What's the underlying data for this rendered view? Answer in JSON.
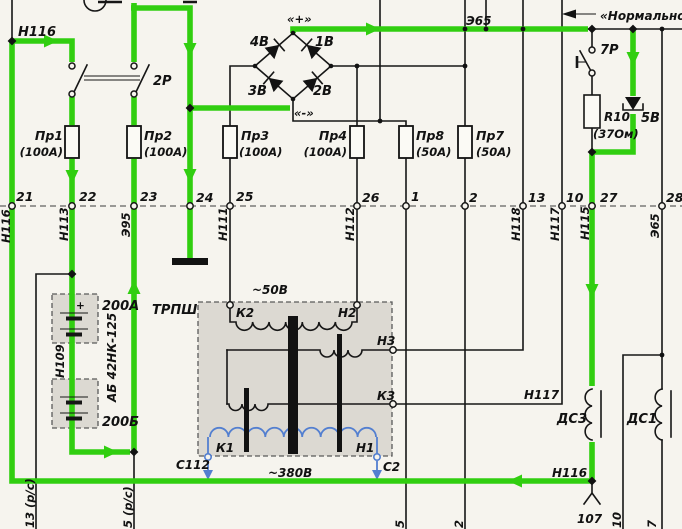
{
  "colors": {
    "wire_active": "#31ce10",
    "winding_blue": "#537fd0",
    "paper": "#f6f4ee",
    "panel_fill": "#dcd9d2"
  },
  "top_left": {
    "wire_label": "Н116"
  },
  "switches": {
    "s2p": "2Р",
    "s7p": "7Р"
  },
  "bridge": {
    "plus": "«+»",
    "minus": "«-»",
    "d1": "1В",
    "d2": "2В",
    "d3": "3В",
    "d4": "4В"
  },
  "top_right": {
    "bus": "Э65",
    "note": "«Нормально",
    "resistor": "R10",
    "resistor_value": "(37Ом)",
    "diode": "5В"
  },
  "fuses": [
    {
      "name": "Пр1",
      "rating": "(100А)"
    },
    {
      "name": "Пр2",
      "rating": "(100А)"
    },
    {
      "name": "Пр3",
      "rating": "(100А)"
    },
    {
      "name": "Пр4",
      "rating": "(100А)"
    },
    {
      "name": "Пр8",
      "rating": "(50А)"
    },
    {
      "name": "Пр7",
      "rating": "(50А)"
    }
  ],
  "terminals": [
    {
      "num": "21",
      "wire": "Н116"
    },
    {
      "num": "22",
      "wire": "Н113"
    },
    {
      "num": "23",
      "wire": "Э95"
    },
    {
      "num": "24",
      "wire": ""
    },
    {
      "num": "25",
      "wire": "Н111"
    },
    {
      "num": "26",
      "wire": "Н112"
    },
    {
      "num": "1",
      "wire": ""
    },
    {
      "num": "2",
      "wire": ""
    },
    {
      "num": "13",
      "wire": "Н118"
    },
    {
      "num": "10",
      "wire": "Н117"
    },
    {
      "num": "27",
      "wire": "Н115"
    },
    {
      "num": "28",
      "wire": "Э65"
    }
  ],
  "battery": {
    "bank_top": "200А",
    "bank_bottom": "200Б",
    "wire": "Н109",
    "type": "АБ 42НК-125"
  },
  "transformer": {
    "name": "ТРПШ",
    "secondary": "~50В",
    "primary": "~380В",
    "k2": "К2",
    "h2": "Н2",
    "h3": "Н3",
    "k3": "К3",
    "k1": "К1",
    "h1": "Н1",
    "c112": "С112",
    "c2": "С2"
  },
  "chokes": {
    "ds3": "ДС3",
    "ds1": "ДС1"
  },
  "wires_right": {
    "h117": "Н117",
    "h116": "Н116",
    "connector": "107"
  },
  "bottom_labels": {
    "rs_left": "13 (р/с)",
    "rs_mid": "5 (р/с)",
    "f1": "5",
    "f2": "2",
    "f3": "10",
    "f4": "7"
  }
}
